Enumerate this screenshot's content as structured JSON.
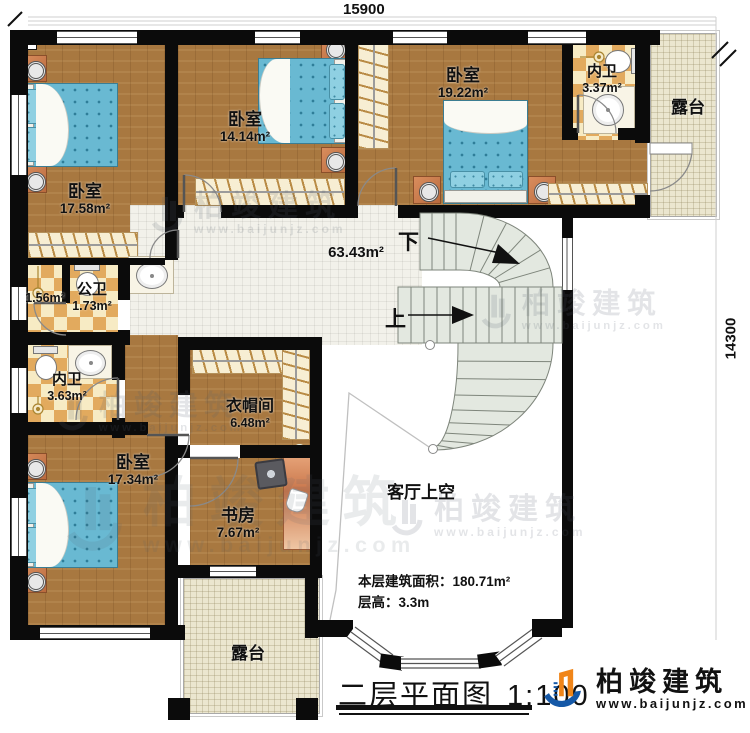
{
  "dimensions": {
    "top": "15900",
    "right": "14300"
  },
  "rooms": {
    "bedroom_tl": {
      "name": "卧室",
      "area": "17.58m²"
    },
    "bedroom_tm": {
      "name": "卧室",
      "area": "14.14m²"
    },
    "bedroom_tr": {
      "name": "卧室",
      "area": "19.22m²"
    },
    "bath_tr": {
      "name": "内卫",
      "area": "3.37m²"
    },
    "terrace_right": {
      "name": "露台"
    },
    "hall": {
      "area": "63.43m²"
    },
    "bath_ante": {
      "area": "1.56m²"
    },
    "bath_public": {
      "name": "公卫",
      "area": "1.73m²"
    },
    "bath_left": {
      "name": "内卫",
      "area": "3.63m²"
    },
    "cloakroom": {
      "name": "衣帽间",
      "area": "6.48m²"
    },
    "bedroom_bl": {
      "name": "卧室",
      "area": "17.34m²"
    },
    "study": {
      "name": "书房",
      "area": "7.67m²"
    },
    "terrace_bottom": {
      "name": "露台"
    },
    "void": {
      "name": "客厅上空"
    }
  },
  "stairs": {
    "down": "下",
    "up": "上"
  },
  "notes": {
    "floor_area": "本层建筑面积：180.71m²",
    "floor_height": "层高：3.3m"
  },
  "title": {
    "text": "二层平面图",
    "scale": "1:100"
  },
  "brand": {
    "name": "柏竣建筑",
    "site": "www.baijunjz.com"
  },
  "watermark": {
    "name": "柏竣建筑",
    "site": "www.baijunjz.com"
  },
  "colors": {
    "wall": "#0b0b0b",
    "wood": "#a87840",
    "tile_dark": "#e2aa5e",
    "tile_light": "#f7ebc4",
    "bed": "#69b9d2",
    "brand_blue": "#1558a7",
    "brand_orange": "#f08519"
  }
}
